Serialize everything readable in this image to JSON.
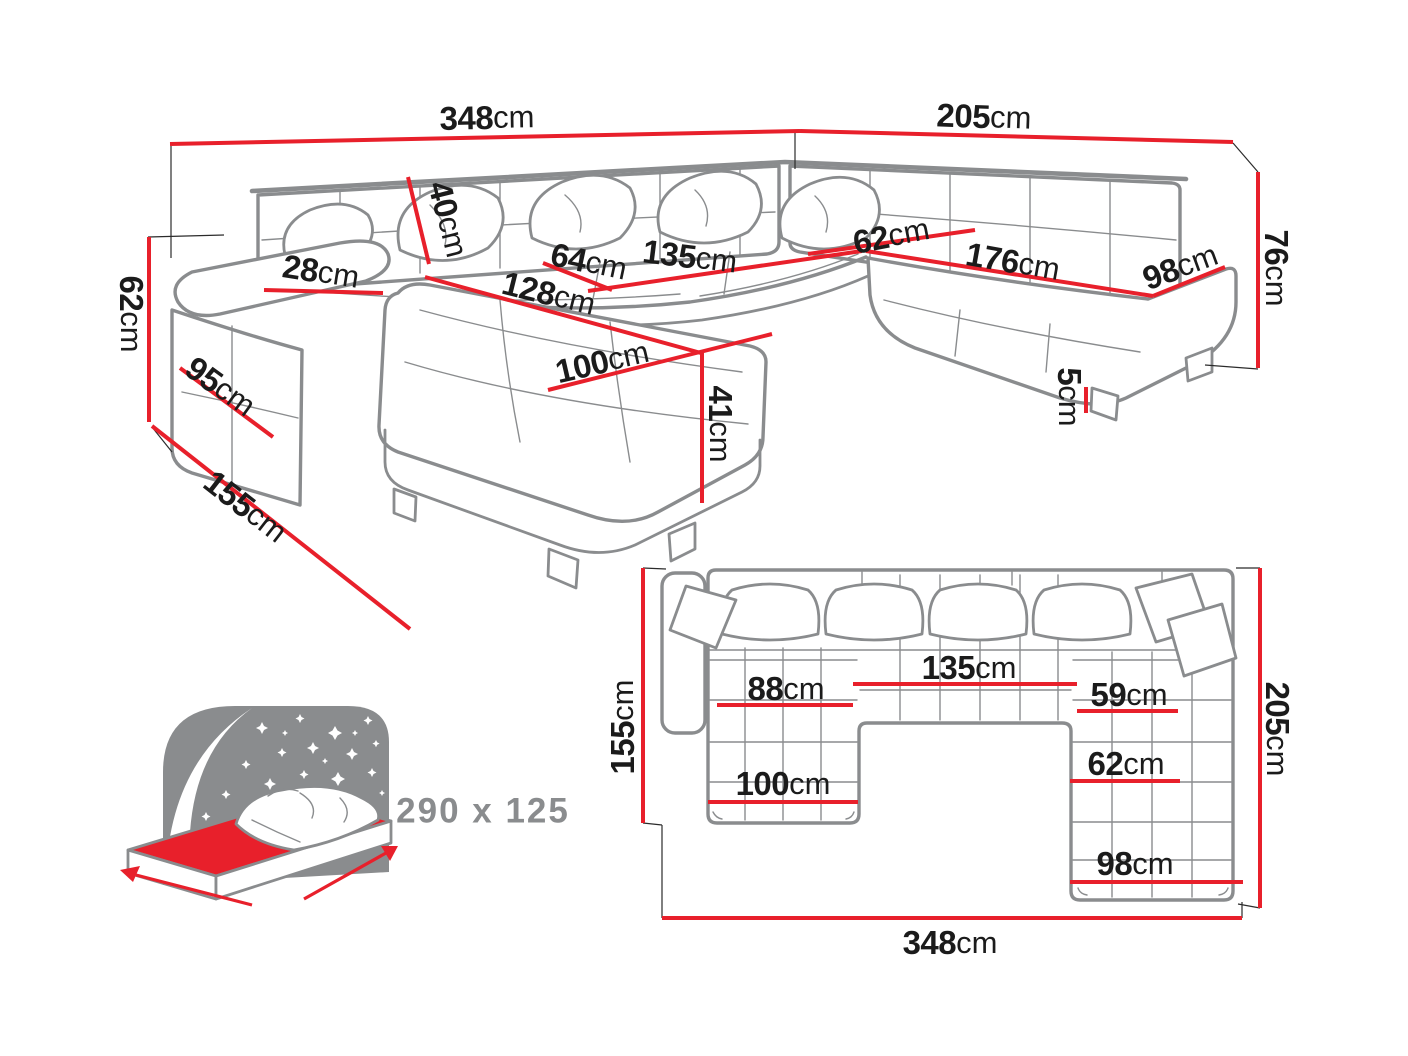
{
  "unit": "cm",
  "colors": {
    "dimension": "#e8202b",
    "sketch_gray": "#8a8c8e",
    "label_black": "#1b1b1b"
  },
  "perspective": {
    "back_width": "348",
    "right_depth": "205",
    "back_height": "76",
    "armrest_height": "62",
    "left_depth": "155",
    "armrest_length": "95",
    "armrest_top_width": "28",
    "backrest_cushion_height": "40",
    "seat_depth_left": "64",
    "middle_seat_width": "135",
    "chaise_length": "128",
    "seat_depth_right": "62",
    "right_seat_width": "176",
    "end_seat_width": "98",
    "chaise_width": "100",
    "seat_height": "41",
    "leg_height": "5"
  },
  "plan": {
    "left_depth": "155",
    "right_depth": "205",
    "total_width": "348",
    "chaise_inner_width": "88",
    "middle_seat_width": "135",
    "right_inner_width": "59",
    "right_seat_width": "62",
    "chaise_width": "100",
    "end_seat_width": "98"
  },
  "sleeping_area": {
    "label": "290 x 125"
  }
}
